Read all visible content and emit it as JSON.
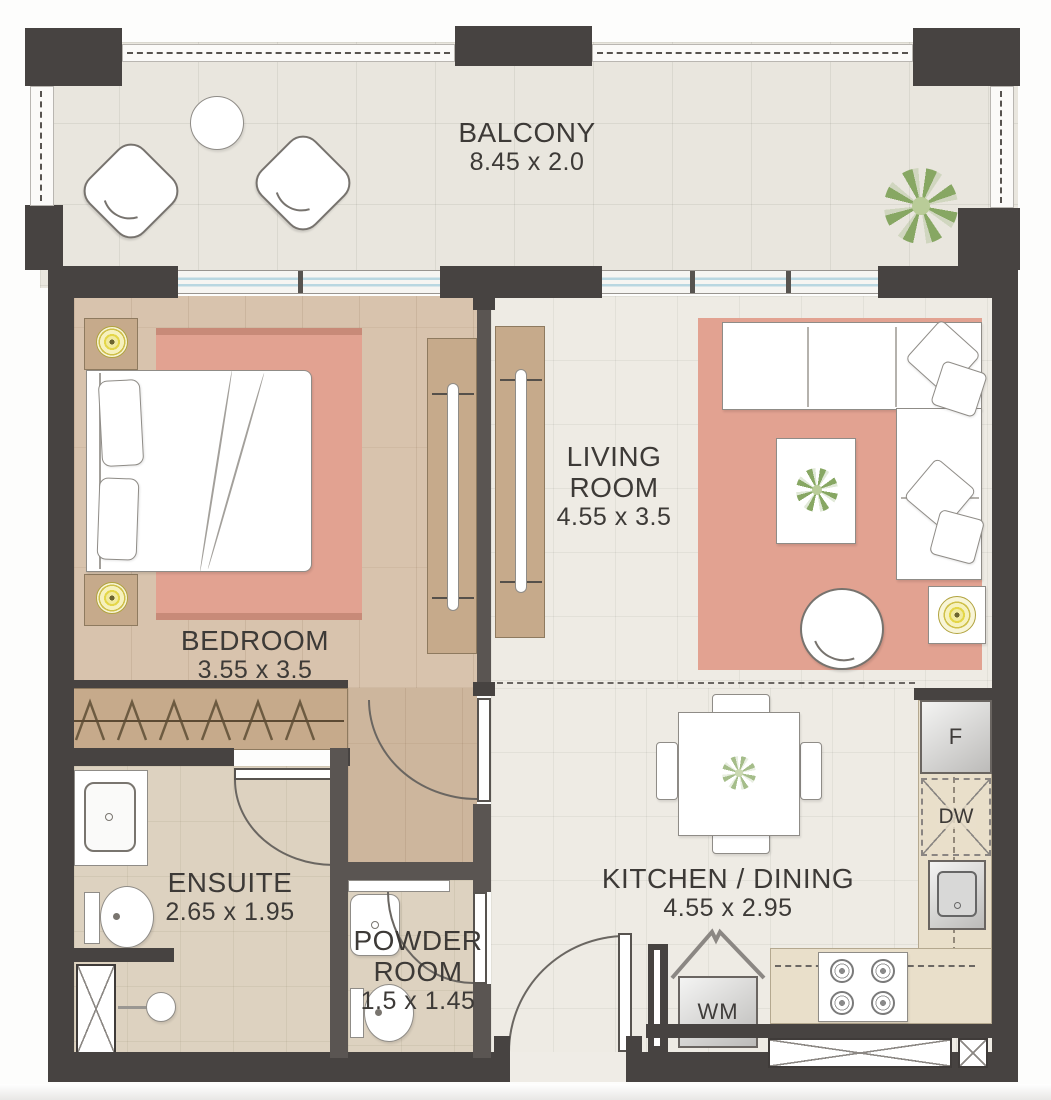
{
  "plan_title": "One Bedroom Apartment Floor Plan",
  "rooms": {
    "balcony": {
      "name": "BALCONY",
      "dims": "8.45 x 2.0"
    },
    "living_room": {
      "line1": "LIVING",
      "line2": "ROOM",
      "dims": "4.55 x 3.5"
    },
    "bedroom": {
      "name": "BEDROOM",
      "dims": "3.55 x 3.5"
    },
    "ensuite": {
      "name": "ENSUITE",
      "dims": "2.65 x 1.95"
    },
    "powder_room": {
      "line1": "POWDER",
      "line2": "ROOM",
      "dims": "1.5 x 1.45"
    },
    "kitchen_dining": {
      "name": "KITCHEN / DINING",
      "dims": "4.55 x 2.95"
    }
  },
  "appliances": {
    "fridge_label": "F",
    "dishwasher_label": "DW",
    "washer_label": "WM"
  },
  "colors": {
    "wall_dark": "#474341",
    "wall_mid": "#5a5552",
    "floor_balcony": "#e9e6de",
    "floor_marble": "#eeebe4",
    "floor_wood": "#d8c3ad",
    "floor_wood_dark": "#cdb69d",
    "floor_tile": "#ddd2c0",
    "rug_pink": "#e2a291",
    "wood_cabinet": "#c6aa8b",
    "glazing_blue": "#b9d7e1",
    "lamp_yellow": "#e8dc5e",
    "plant_green": "#87a763",
    "line_grey": "#8f8c87",
    "text_dark": "#3d3a37"
  }
}
